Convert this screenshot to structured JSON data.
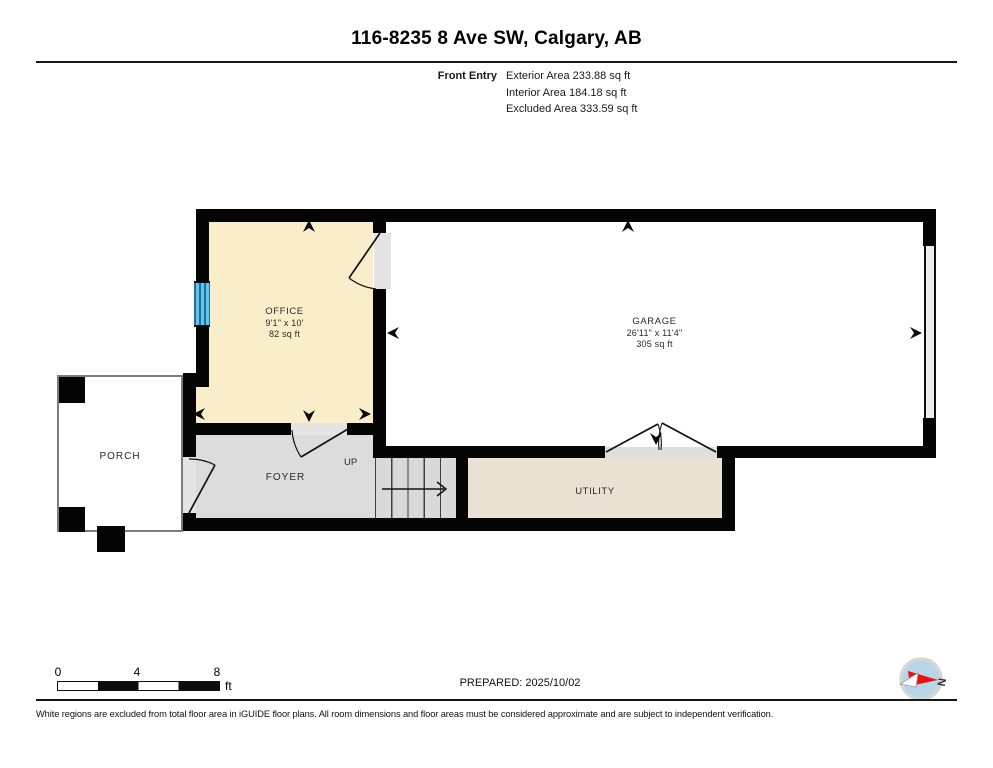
{
  "page": {
    "title": "116-8235 8 Ave SW, Calgary, AB"
  },
  "summary": {
    "plan_name": "Front Entry",
    "lines": [
      "Exterior Area 233.88 sq ft",
      "Interior Area 184.18 sq ft",
      "Excluded Area 333.59 sq ft"
    ]
  },
  "rooms": {
    "office": {
      "name": "OFFICE",
      "dimensions": "9'1\" x 10'",
      "area": "82 sq ft"
    },
    "garage": {
      "name": "GARAGE",
      "dimensions": "26'11\" x 11'4\"",
      "area": "305 sq ft"
    },
    "porch": {
      "name": "PORCH"
    },
    "foyer": {
      "name": "FOYER"
    },
    "utility": {
      "name": "UTILITY"
    },
    "stairs": {
      "direction_label": "UP"
    }
  },
  "scale_bar": {
    "ticks": [
      "0",
      "4",
      "8"
    ],
    "unit": "ft"
  },
  "compass": {
    "north_label": "N"
  },
  "footer": {
    "prepared": "PREPARED: 2025/10/02",
    "disclaimer": "White regions are excluded from total floor area in iGUIDE floor plans. All room dimensions and floor areas must be considered approximate and are subject to independent verification."
  },
  "colors": {
    "wall": "#050505",
    "office_fill": "#faeeca",
    "foyer_fill": "#dcdcdc",
    "utility_fill": "#e9e1d1",
    "window_blue": "#62c2e8",
    "compass_red": "#e8150e"
  }
}
